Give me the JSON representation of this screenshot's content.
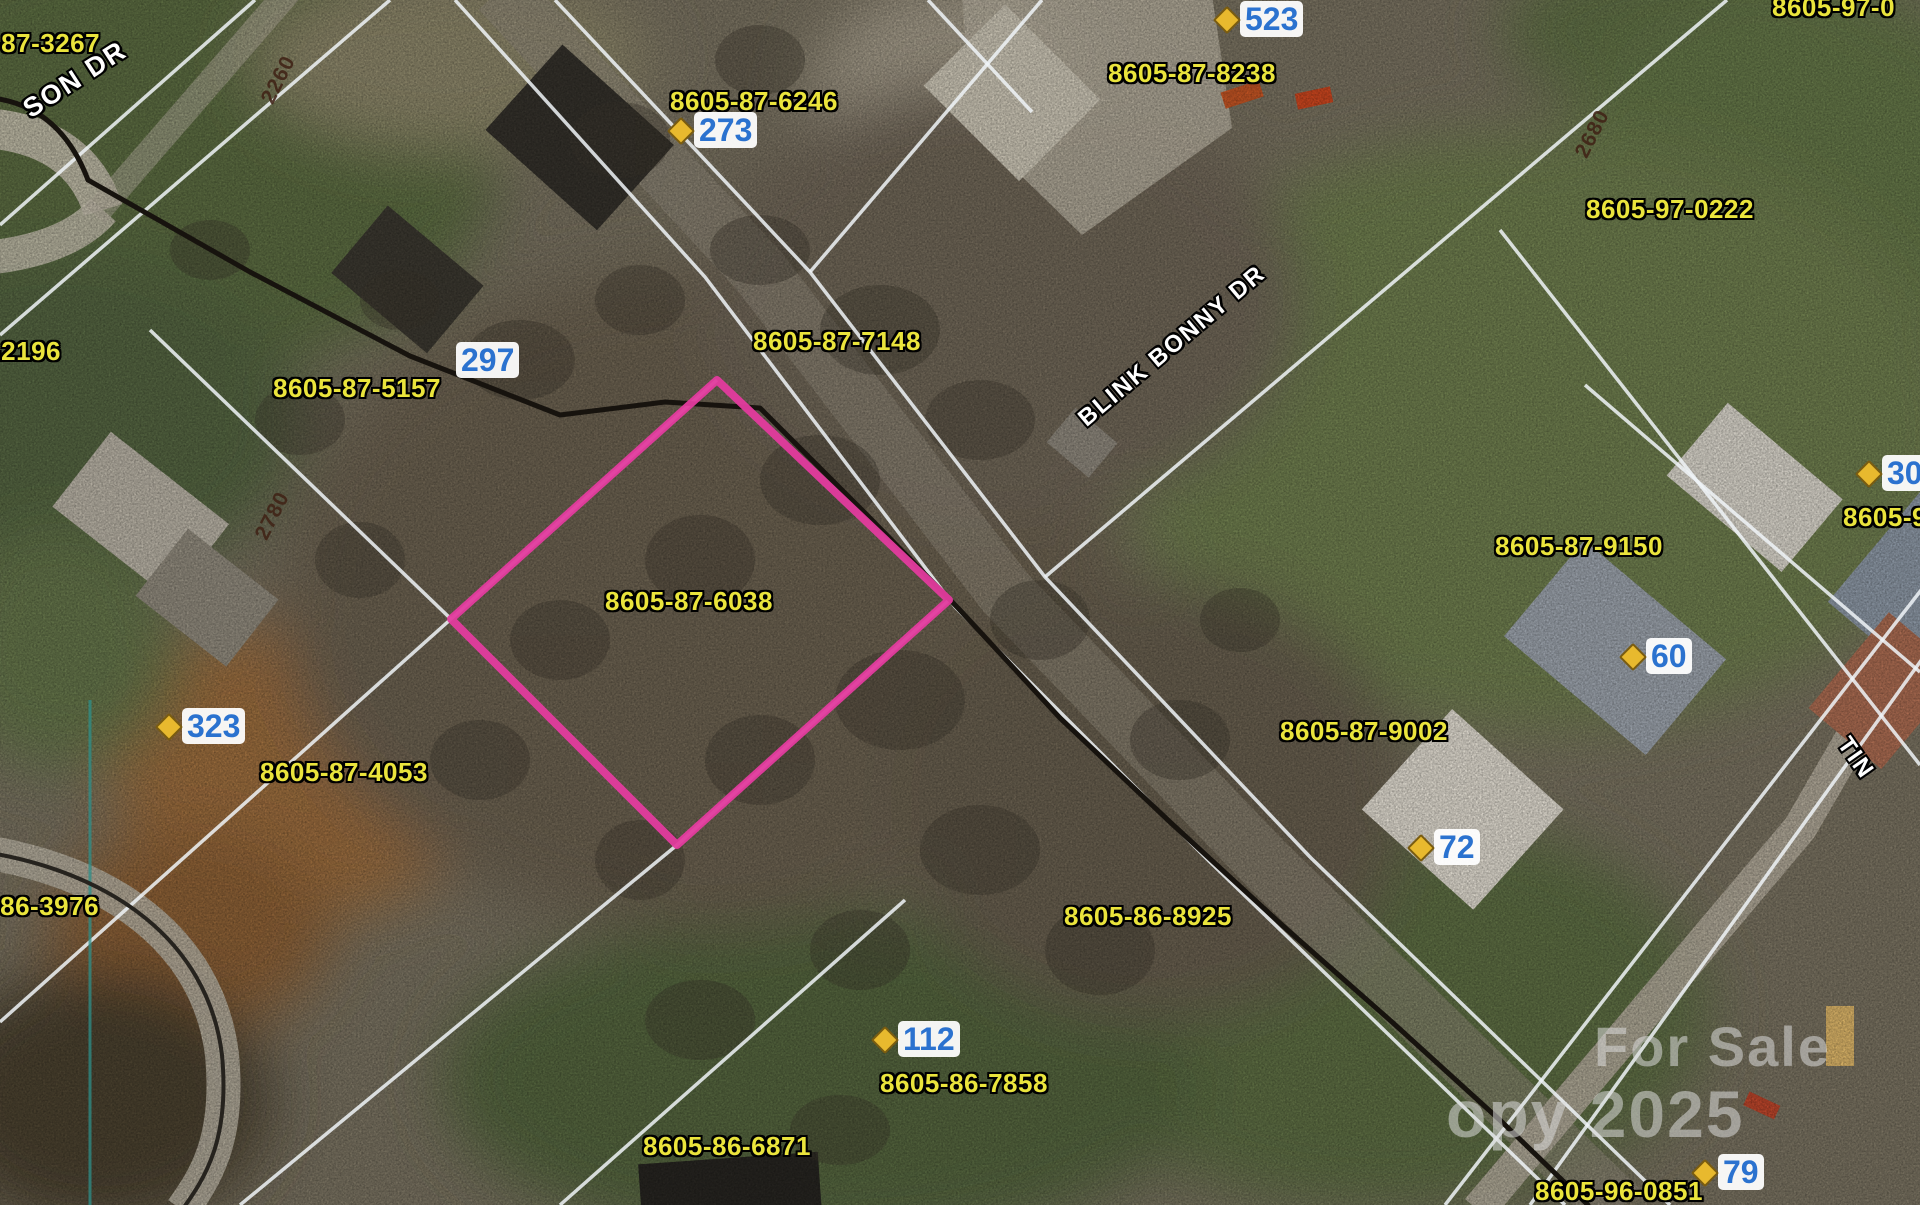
{
  "map": {
    "type": "aerial-parcel-map",
    "highlight": {
      "parcel_id": "8605-87-6038",
      "outline_color": "#e33b9e"
    },
    "colors": {
      "parcel_label": "#eae43c",
      "address_label": "#2b72cf",
      "parcel_line": "#eef2f6",
      "road_centerline": "#17130e"
    },
    "labels": {
      "parcels": [
        {
          "text": "-87-3267"
        },
        {
          "text": "8605-87-6246"
        },
        {
          "text": "8605-87-8238"
        },
        {
          "text": "8605-97-0"
        },
        {
          "text": "8605-97-0222"
        },
        {
          "text": "-2196"
        },
        {
          "text": "8605-87-5157"
        },
        {
          "text": "8605-87-7148"
        },
        {
          "text": "8605-87-6038"
        },
        {
          "text": "8605-87-4053"
        },
        {
          "text": "5-86-3976"
        },
        {
          "text": "8605-86-8925"
        },
        {
          "text": "8605-86-7858"
        },
        {
          "text": "8605-86-6871"
        },
        {
          "text": "8605-87-9150"
        },
        {
          "text": "8605-87-9002"
        },
        {
          "text": "8605-96-0851"
        },
        {
          "text": "8605-9"
        }
      ],
      "addresses": [
        {
          "number": "273"
        },
        {
          "number": "523"
        },
        {
          "number": "297"
        },
        {
          "number": "323"
        },
        {
          "number": "60"
        },
        {
          "number": "72"
        },
        {
          "number": "112"
        },
        {
          "number": "79"
        },
        {
          "number": "30"
        }
      ],
      "streets": [
        {
          "text": "SON DR"
        },
        {
          "text": "BLINK BONNY DR"
        },
        {
          "text": "TIN"
        }
      ],
      "road_numbers": [
        {
          "text": "2260"
        },
        {
          "text": "2680"
        },
        {
          "text": "2780"
        }
      ],
      "watermark": {
        "line1": "For Sale",
        "line2": "opy 2025"
      }
    }
  }
}
